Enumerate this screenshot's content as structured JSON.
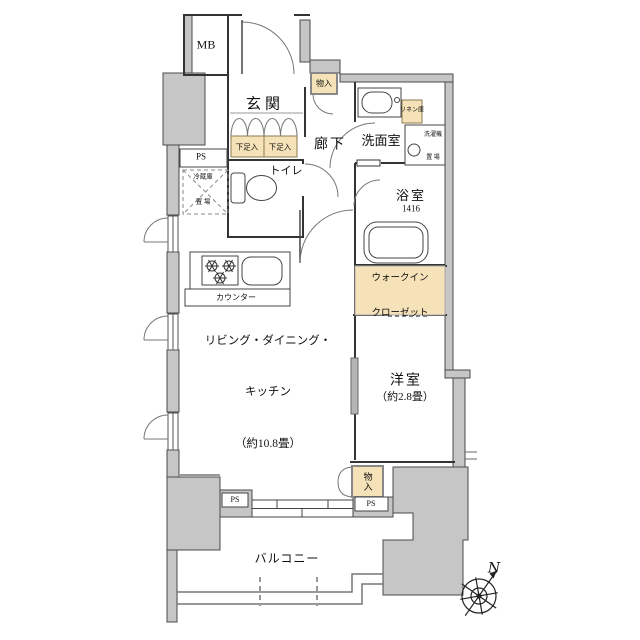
{
  "plan": {
    "labels": {
      "mb": "MB",
      "genkan": "玄関",
      "monoire_top": "物入",
      "rouka": "廊下",
      "senmen": "洗面室",
      "linen": "リネン庫",
      "washer_l1": "洗濯機",
      "washer_l2": "置 場",
      "bath": "浴室",
      "bath_size": "1416",
      "toilet": "トイレ",
      "gesoku": "下足入",
      "ps": "PS",
      "fridge_l1": "冷蔵庫",
      "fridge_l2": "置 場",
      "counter": "カウンター",
      "ldk_l1": "リビング・ダイニング・",
      "ldk_l2": "キッチン",
      "ldk_l3": "（約10.8畳）",
      "yoshitsu": "洋室",
      "yoshitsu_size": "（約2.8畳）",
      "wic_l1": "ウォークイン",
      "wic_l2": "クローゼット",
      "monoire_bottom": "物入",
      "balcony": "バルコニー",
      "north": "N"
    },
    "colors": {
      "wall_fill": "#c6c6c6",
      "storage_fill": "#f5e2b8",
      "line": "#333333",
      "background": "#ffffff"
    }
  }
}
